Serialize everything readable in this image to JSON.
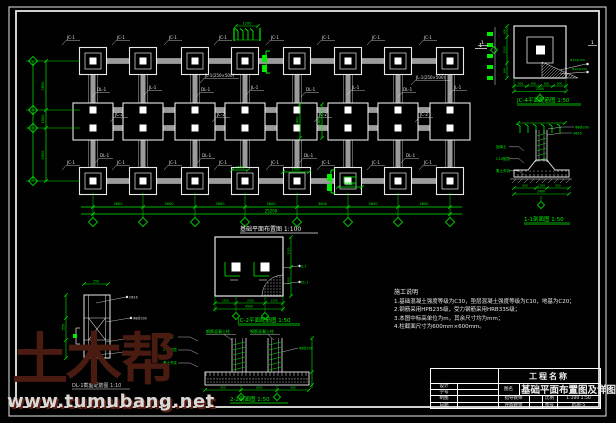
{
  "colors": {
    "bg": "#010101",
    "line": "#e8e8e8",
    "beam_gray": "#9b9b9b",
    "green": "#00ee00",
    "watermark": "#4a1b10",
    "watermark_text": "#d8d8d8"
  },
  "plan": {
    "title": "基础平面布置图 1:100",
    "bay_dims": [
      "3600",
      "3600",
      "3600",
      "3600",
      "3600",
      "3600",
      "3600"
    ],
    "total_dim": "25200",
    "left_dims": [
      "3600",
      "1500",
      "3900"
    ],
    "rebar_detail_dim": "1200",
    "section_marker": "1",
    "callouts": [
      {
        "x": 67,
        "y": 39,
        "t": "JC-1"
      },
      {
        "x": 117,
        "y": 39,
        "t": "JC-1"
      },
      {
        "x": 169,
        "y": 39,
        "t": "JC-1"
      },
      {
        "x": 219,
        "y": 39,
        "t": "JC-1"
      },
      {
        "x": 271,
        "y": 39,
        "t": "JC-1"
      },
      {
        "x": 322,
        "y": 39,
        "t": "JC-1"
      },
      {
        "x": 372,
        "y": 39,
        "t": "JC-1"
      },
      {
        "x": 424,
        "y": 39,
        "t": "JC-1"
      },
      {
        "x": 97,
        "y": 91,
        "t": "DL-1"
      },
      {
        "x": 149,
        "y": 89,
        "t": "JL-1"
      },
      {
        "x": 201,
        "y": 91,
        "t": "DL-1"
      },
      {
        "x": 251,
        "y": 89,
        "t": "JL-1"
      },
      {
        "x": 306,
        "y": 91,
        "t": "DL-1"
      },
      {
        "x": 352,
        "y": 89,
        "t": "JL-1"
      },
      {
        "x": 403,
        "y": 91,
        "t": "DL-1"
      },
      {
        "x": 454,
        "y": 89,
        "t": "JL-1"
      },
      {
        "x": 115,
        "y": 116,
        "t": "JC-2"
      },
      {
        "x": 217,
        "y": 116,
        "t": "JC-2"
      },
      {
        "x": 319,
        "y": 116,
        "t": "JC-2"
      },
      {
        "x": 420,
        "y": 116,
        "t": "JC-2"
      },
      {
        "x": 100,
        "y": 157,
        "t": "DL-1"
      },
      {
        "x": 202,
        "y": 157,
        "t": "DL-1"
      },
      {
        "x": 304,
        "y": 157,
        "t": "DL-1"
      },
      {
        "x": 406,
        "y": 157,
        "t": "DL-1"
      },
      {
        "x": 67,
        "y": 164,
        "t": "JC-1"
      },
      {
        "x": 117,
        "y": 164,
        "t": "JC-1"
      },
      {
        "x": 169,
        "y": 164,
        "t": "JC-1"
      },
      {
        "x": 219,
        "y": 164,
        "t": "JC-1"
      },
      {
        "x": 271,
        "y": 164,
        "t": "JC-1"
      },
      {
        "x": 322,
        "y": 164,
        "t": "JC-1"
      },
      {
        "x": 372,
        "y": 164,
        "t": "JC-1"
      },
      {
        "x": 424,
        "y": 164,
        "t": "JC-1"
      }
    ],
    "beam_callouts": [
      {
        "x": 205,
        "y": 77,
        "t": "JL-1(250×500)"
      },
      {
        "x": 416,
        "y": 79,
        "t": "JL-1(250×500)"
      }
    ],
    "green_dims": [
      {
        "type": "h",
        "x1": 232,
        "x2": 248,
        "y": 170,
        "t": "1500"
      },
      {
        "type": "h",
        "x1": 283,
        "x2": 309,
        "y": 172,
        "t": "1500"
      },
      {
        "type": "hbox",
        "x1": 338,
        "x2": 362,
        "y": 187,
        "t": "1500"
      },
      {
        "type": "v",
        "x": 322,
        "y1": 104,
        "y2": 138,
        "t": "2400"
      },
      {
        "type": "v",
        "x": 300,
        "y1": 104,
        "y2": 138,
        "t": "2400"
      }
    ]
  },
  "details": {
    "jc4": {
      "label": "JC-4平面配筋图 1:50",
      "marker": "1",
      "bottom_dims": [
        "600",
        "600",
        "600",
        "600"
      ],
      "bottom_total": "2400",
      "left_dims": [
        "600",
        "1200",
        "600"
      ],
      "leaders": [
        "Φ12@150",
        "Φ12@150"
      ]
    },
    "s11": {
      "label": "1-1剖面图 1:50",
      "right_leaders": [
        "Φ8@200",
        "4Φ16"
      ],
      "left_leaders": [
        "回填土",
        "C10垫层",
        "素土夯实"
      ],
      "bottom_dims": [
        "600",
        "1200",
        "600"
      ],
      "bottom_total": "2400"
    },
    "jc2": {
      "label": "JC-2平面配筋图 1:50",
      "bottom_dims": [
        "1200",
        "2100",
        "1200"
      ],
      "bottom_total": "4500",
      "right_dims": [
        "1200",
        "2100",
        "1200"
      ],
      "right_leaders": [
        "JL-1",
        "DL-1"
      ]
    },
    "dl1": {
      "label": "DL-1截面配筋图 1:10",
      "top_dim": "250",
      "left_dim": "550",
      "leaders": [
        "2Φ16",
        "Φ8@200",
        "2Φ16",
        "2Φ12"
      ]
    },
    "s22": {
      "label": "2-2剖面图 1:50",
      "column_label": "钢筋混凝土柱",
      "left_leaders": [
        "基础梁",
        "C10垫层",
        "素土夯实"
      ],
      "right_leader": "Φ8@200",
      "bottom_dims": [
        "900",
        "1800",
        "900"
      ]
    }
  },
  "notes": {
    "title": "施工说明",
    "items": [
      "1.基础混凝土强度等级为C30，垫层混凝土强度等级为C10，地基为C20；",
      "2.钢筋采用HPB235级，受力钢筋采用HRB335级；",
      "3.本图中标高单位为m，其余尺寸均为mm；",
      "4.柱截面尺寸为600mm×600mm。"
    ]
  },
  "title_block": {
    "project_label": "工程名称",
    "drawing_name_label": "图名",
    "drawing_name": "基础平面布置图及详图",
    "rows_left": [
      {
        "label": "设计"
      },
      {
        "label": "学号"
      },
      {
        "label": "制图"
      },
      {
        "label": "日期"
      }
    ],
    "advisor_label": "指导教师",
    "reviewer_label": "评阅教师",
    "scale_label": "比例",
    "scale_value": "1:100 1:50",
    "sheet_label": "图号",
    "sheet_value": "结施-5"
  },
  "watermark": {
    "brand": "土木帮",
    "url": "www.tumubang.net"
  }
}
